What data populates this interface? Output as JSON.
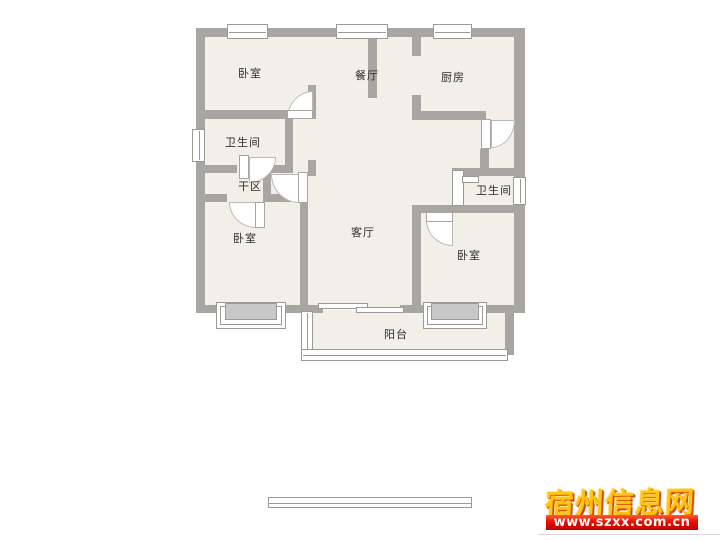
{
  "palette": {
    "wall": "#a8a6a3",
    "floor": "#f1efe7",
    "symbol_border": "#9b9a97",
    "bay_window_fill": "#c9c8c9",
    "label_color": "#2e2d2b",
    "watermark_gold": "#ffc414",
    "watermark_red": "#e05a00",
    "banner_red": "#ea0d00",
    "banner_text": "#ffffff"
  },
  "floorplan": {
    "type": "apartment-floor-plan",
    "rooms": [
      {
        "id": "bedroom-top-left",
        "label": "卧室"
      },
      {
        "id": "dining-room",
        "label": "餐厅"
      },
      {
        "id": "kitchen",
        "label": "厨房"
      },
      {
        "id": "bathroom-left",
        "label": "卫生间"
      },
      {
        "id": "dry-area",
        "label": "干区"
      },
      {
        "id": "bedroom-left",
        "label": "卧室"
      },
      {
        "id": "living-room",
        "label": "客厅"
      },
      {
        "id": "bathroom-right",
        "label": "卫生间"
      },
      {
        "id": "bedroom-right",
        "label": "卧室"
      },
      {
        "id": "balcony",
        "label": "阳台"
      }
    ]
  },
  "watermark": {
    "site_name": "宿州信息网",
    "url": "www.szxx.com.cn"
  }
}
